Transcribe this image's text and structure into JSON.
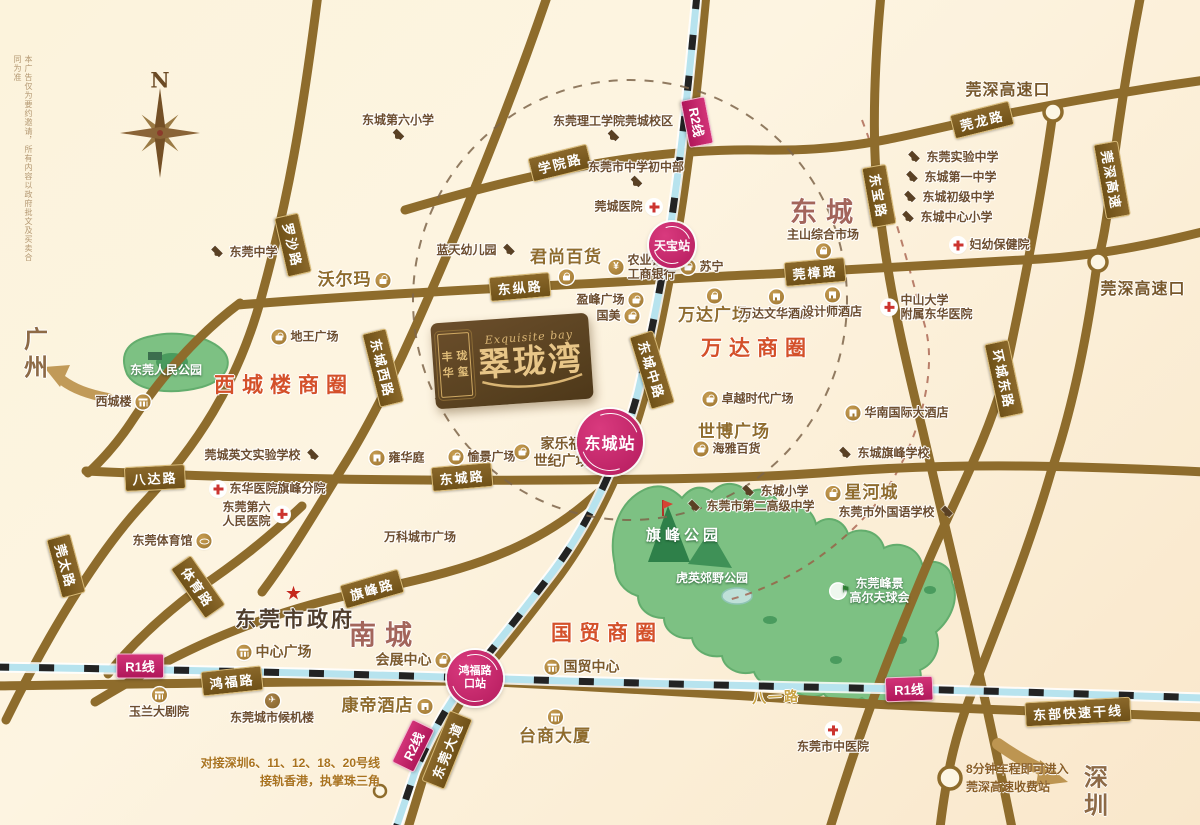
{
  "title_logo": {
    "en": "Exquisite bay",
    "zh": "翠珑湾",
    "seal": [
      "丰",
      "珑",
      "华",
      "玺"
    ]
  },
  "compass": "N",
  "disclaimer": "本广告仅为要约邀请，所有内容以政府批文及买卖合同为准",
  "districts": [
    {
      "label": "东城",
      "x": 826,
      "y": 210
    },
    {
      "label": "南城",
      "x": 385,
      "y": 633
    }
  ],
  "business_circles": [
    {
      "label": "西城楼商圈",
      "x": 284,
      "y": 384
    },
    {
      "label": "万达商圈",
      "x": 757,
      "y": 347
    },
    {
      "label": "国贸商圈",
      "x": 607,
      "y": 632
    }
  ],
  "city_labels": [
    {
      "lines": [
        "广",
        "州"
      ],
      "x": 36,
      "y": 354
    },
    {
      "lines": [
        "深",
        "圳"
      ],
      "x": 1096,
      "y": 792
    }
  ],
  "highway_exits": [
    {
      "label": "莞深高速口",
      "x": 1008,
      "y": 88
    },
    {
      "label": "莞深高速口",
      "x": 1143,
      "y": 287
    }
  ],
  "road_badges": [
    {
      "label": "罗沙路",
      "x": 293,
      "y": 245,
      "rot": 77
    },
    {
      "label": "学院路",
      "x": 560,
      "y": 163,
      "rot": -14
    },
    {
      "label": "莞龙路",
      "x": 982,
      "y": 120,
      "rot": -14
    },
    {
      "label": "东宝路",
      "x": 879,
      "y": 196,
      "rot": 80
    },
    {
      "label": "莞深高速",
      "x": 1112,
      "y": 180,
      "rot": 80
    },
    {
      "label": "东纵路",
      "x": 520,
      "y": 287,
      "rot": -5
    },
    {
      "label": "莞樟路",
      "x": 815,
      "y": 272,
      "rot": -5
    },
    {
      "label": "东城西路",
      "x": 383,
      "y": 368,
      "rot": 76
    },
    {
      "label": "东城中路",
      "x": 652,
      "y": 370,
      "rot": 73
    },
    {
      "label": "环城东路",
      "x": 1004,
      "y": 379,
      "rot": 78
    },
    {
      "label": "八达路",
      "x": 155,
      "y": 478,
      "rot": -3
    },
    {
      "label": "东城路",
      "x": 462,
      "y": 477,
      "rot": -5
    },
    {
      "label": "莞太路",
      "x": 66,
      "y": 566,
      "rot": 75
    },
    {
      "label": "体育路",
      "x": 198,
      "y": 587,
      "rot": 55
    },
    {
      "label": "旗峰路",
      "x": 372,
      "y": 589,
      "rot": -16
    },
    {
      "label": "鸿福路",
      "x": 232,
      "y": 681,
      "rot": -6
    },
    {
      "label": "东莞大道",
      "x": 447,
      "y": 750,
      "rot": -68
    },
    {
      "label": "东部快速干线",
      "x": 1078,
      "y": 712,
      "rot": -3
    }
  ],
  "road_texts": [
    {
      "label": "八一路",
      "x": 776,
      "y": 697,
      "rot": -3
    }
  ],
  "metro": {
    "line_badges": [
      {
        "label": "R2线",
        "x": 697,
        "y": 122,
        "rot": 79
      },
      {
        "label": "R2线",
        "x": 413,
        "y": 746,
        "rot": -64
      },
      {
        "label": "R1线",
        "x": 140,
        "y": 666,
        "rot": 0
      },
      {
        "label": "R1线",
        "x": 909,
        "y": 689,
        "rot": -2
      }
    ],
    "stations": [
      {
        "label": "天宝站",
        "x": 672,
        "y": 245,
        "size": "sm"
      },
      {
        "label": "东城站",
        "x": 610,
        "y": 442,
        "size": "lg"
      },
      {
        "lines": [
          "鸿福路",
          "口站"
        ],
        "x": 475,
        "y": 678,
        "size": "md"
      }
    ]
  },
  "park_labels": [
    {
      "label": "东莞人民公园",
      "x": 166,
      "y": 370
    },
    {
      "label": "旗峰公园",
      "x": 684,
      "y": 536,
      "size": "big"
    },
    {
      "label": "虎英郊野公园",
      "x": 712,
      "y": 578
    },
    {
      "lines": [
        "东莞峰景",
        "高尔夫球会"
      ],
      "x": 870,
      "y": 591,
      "ic": "golf"
    }
  ],
  "pois": [
    {
      "label": "东城第六小学",
      "x": 398,
      "y": 127,
      "ic": "school",
      "side": "b"
    },
    {
      "label": "东莞中学",
      "x": 243,
      "y": 252,
      "ic": "school",
      "side": "l"
    },
    {
      "label": "沃尔玛",
      "x": 354,
      "y": 280,
      "ic": "shop",
      "side": "r",
      "size": "lg"
    },
    {
      "label": "东莞理工学院莞城校区",
      "x": 613,
      "y": 128,
      "ic": "school",
      "side": "b"
    },
    {
      "label": "东莞市中学初中部",
      "x": 636,
      "y": 174,
      "ic": "school",
      "side": "b"
    },
    {
      "label": "莞城医院",
      "x": 628,
      "y": 207,
      "ic": "hosp",
      "side": "r"
    },
    {
      "label": "蓝天幼儿园",
      "x": 477,
      "y": 250,
      "ic": "school",
      "side": "r"
    },
    {
      "label": "君尚百货",
      "x": 566,
      "y": 266,
      "ic": "shop",
      "side": "b",
      "size": "lg"
    },
    {
      "lines": [
        "农业银行",
        "工商银行"
      ],
      "x": 642,
      "y": 267,
      "ic": "bank",
      "side": "l"
    },
    {
      "label": "苏宁",
      "x": 702,
      "y": 267,
      "ic": "shop",
      "side": "l"
    },
    {
      "label": "盈峰广场",
      "x": 610,
      "y": 300,
      "ic": "shop",
      "side": "r"
    },
    {
      "label": "国美",
      "x": 618,
      "y": 316,
      "ic": "shop",
      "side": "r"
    },
    {
      "label": "万达广场",
      "x": 714,
      "y": 307,
      "ic": "shop",
      "side": "a",
      "size": "lg"
    },
    {
      "label": "万达文华酒店",
      "x": 776,
      "y": 305,
      "ic": "hotel",
      "side": "a"
    },
    {
      "label": "设计师酒店",
      "x": 832,
      "y": 303,
      "ic": "hotel",
      "side": "a"
    },
    {
      "label": "主山综合市场",
      "x": 823,
      "y": 243,
      "ic": "shop",
      "side": "b"
    },
    {
      "label": "东莞实验中学",
      "x": 952,
      "y": 157,
      "ic": "school",
      "side": "l"
    },
    {
      "label": "东城第一中学",
      "x": 950,
      "y": 177,
      "ic": "school",
      "side": "l"
    },
    {
      "label": "东城初级中学",
      "x": 948,
      "y": 197,
      "ic": "school",
      "side": "l"
    },
    {
      "label": "东城中心小学",
      "x": 946,
      "y": 217,
      "ic": "school",
      "side": "l"
    },
    {
      "label": "妇幼保健院",
      "x": 990,
      "y": 245,
      "ic": "hosp",
      "side": "l"
    },
    {
      "lines": [
        "中山大学",
        "附属东华医院"
      ],
      "x": 927,
      "y": 307,
      "ic": "hosp",
      "side": "l",
      "align": "left"
    },
    {
      "label": "地王广场",
      "x": 305,
      "y": 337,
      "ic": "shop",
      "side": "l"
    },
    {
      "label": "西城楼",
      "x": 123,
      "y": 402,
      "ic": "bldg",
      "side": "r"
    },
    {
      "label": "莞城英文实验学校",
      "x": 263,
      "y": 455,
      "ic": "school",
      "side": "r"
    },
    {
      "label": "雍华庭",
      "x": 397,
      "y": 458,
      "ic": "hotel",
      "side": "l"
    },
    {
      "label": "愉景广场",
      "x": 482,
      "y": 457,
      "ic": "shop",
      "side": "l"
    },
    {
      "lines": [
        "家乐福",
        "世纪广场"
      ],
      "x": 552,
      "y": 452,
      "ic": "shop",
      "side": "l",
      "size": "md"
    },
    {
      "label": "东华医院旗峰分院",
      "x": 268,
      "y": 489,
      "ic": "hosp",
      "side": "l"
    },
    {
      "lines": [
        "东莞第六",
        "人民医院"
      ],
      "x": 256,
      "y": 514,
      "ic": "hosp",
      "side": "r"
    },
    {
      "label": "东莞体育馆",
      "x": 172,
      "y": 541,
      "ic": "stadium",
      "side": "r"
    },
    {
      "label": "万科城市广场",
      "x": 420,
      "y": 537
    },
    {
      "label": "卓越时代广场",
      "x": 748,
      "y": 399,
      "ic": "shop",
      "side": "l"
    },
    {
      "label": "世博广场",
      "x": 734,
      "y": 432,
      "size": "lg"
    },
    {
      "label": "海雅百货",
      "x": 727,
      "y": 449,
      "ic": "shop",
      "side": "l"
    },
    {
      "label": "东城小学",
      "x": 774,
      "y": 491,
      "ic": "school",
      "side": "l"
    },
    {
      "label": "东莞市第二高级中学",
      "x": 750,
      "y": 506,
      "ic": "school",
      "side": "l"
    },
    {
      "label": "华南国际大酒店",
      "x": 897,
      "y": 413,
      "ic": "hotel",
      "side": "l"
    },
    {
      "label": "东城旗峰学校",
      "x": 883,
      "y": 453,
      "ic": "school",
      "side": "l"
    },
    {
      "label": "星河城",
      "x": 862,
      "y": 493,
      "ic": "shop",
      "side": "l",
      "size": "lg"
    },
    {
      "label": "东莞市外国语学校",
      "x": 897,
      "y": 512,
      "ic": "school",
      "side": "r"
    },
    {
      "label": "东莞市政府",
      "x": 295,
      "y": 610,
      "ic": "star",
      "side": "a",
      "size": "xl"
    },
    {
      "label": "中心广场",
      "x": 274,
      "y": 652,
      "ic": "bldg",
      "side": "l",
      "size": "md"
    },
    {
      "label": "会展中心",
      "x": 413,
      "y": 660,
      "ic": "shop",
      "side": "r",
      "size": "md"
    },
    {
      "label": "玉兰大剧院",
      "x": 159,
      "y": 703,
      "ic": "bldg",
      "side": "a"
    },
    {
      "label": "东莞城市候机楼",
      "x": 272,
      "y": 709,
      "ic": "plane",
      "side": "a"
    },
    {
      "label": "康帝酒店",
      "x": 387,
      "y": 706,
      "ic": "hotel",
      "side": "r",
      "size": "lg"
    },
    {
      "label": "国贸中心",
      "x": 582,
      "y": 667,
      "ic": "bldg",
      "side": "l",
      "size": "md"
    },
    {
      "label": "台商大厦",
      "x": 555,
      "y": 728,
      "ic": "bldg",
      "side": "a",
      "size": "lg"
    },
    {
      "label": "东莞市中医院",
      "x": 833,
      "y": 738,
      "ic": "hosp",
      "side": "a"
    }
  ],
  "notes": [
    {
      "lines": [
        "对接深圳6、11、12、18、20号线",
        "接轨香港，执掌珠三角"
      ],
      "x": 380,
      "y": 772,
      "align": "right"
    },
    {
      "lines": [
        "8分钟车程即可进入",
        "莞深高速收费站"
      ],
      "x": 966,
      "y": 778,
      "align": "left"
    }
  ],
  "colors": {
    "accent_red": "#d4502a",
    "metro_pink": "#c11e62",
    "road_brown": "#8e6c2c",
    "park_green": "#7dc183",
    "rail_cyan": "#b7e3ee"
  }
}
